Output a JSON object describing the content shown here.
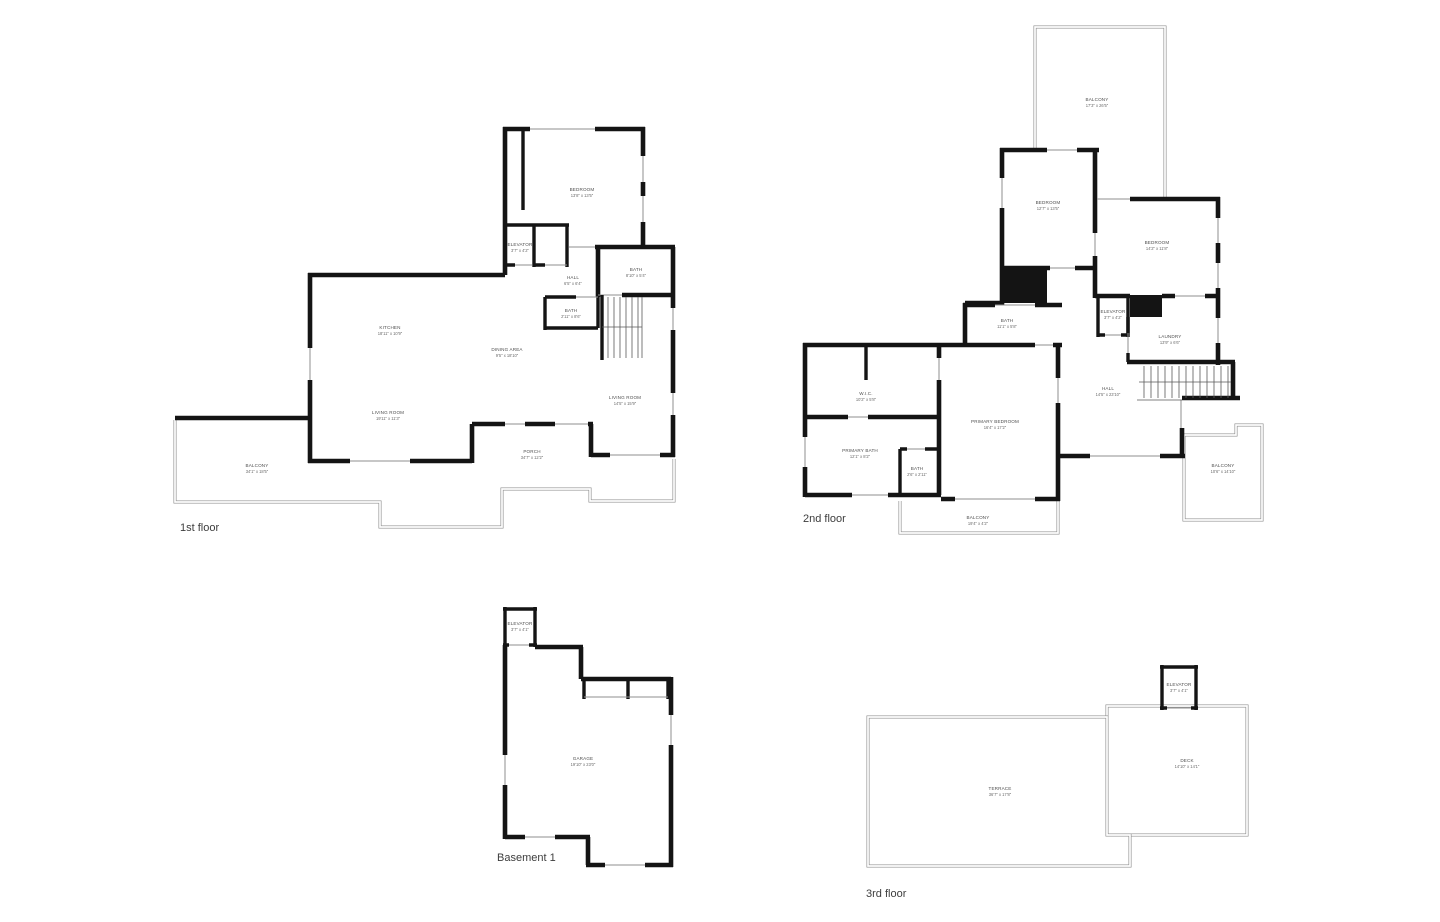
{
  "colors": {
    "wall": "#141414",
    "thin_outline": "#8f8f8f",
    "label_text": "#4f4f4f"
  },
  "floors": {
    "first": {
      "title": "1st floor",
      "rooms": {
        "bedroom": {
          "name": "BEDROOM",
          "dims": "13'8\" x 13'5\""
        },
        "elevator": {
          "name": "ELEVATOR",
          "dims": "3'7\" x 4'2\""
        },
        "hall": {
          "name": "HALL",
          "dims": "6'5\" x 6'4\""
        },
        "bath1": {
          "name": "BATH",
          "dims": "8'10\" x 5'4\""
        },
        "bath2": {
          "name": "BATH",
          "dims": "2'11\" x 8'6\""
        },
        "kitchen": {
          "name": "KITCHEN",
          "dims": "18'11\" x 10'9\""
        },
        "dining": {
          "name": "DINING AREA",
          "dims": "9'5\" x 18'10\""
        },
        "living1": {
          "name": "LIVING ROOM",
          "dims": "19'11\" x 11'3\""
        },
        "living2": {
          "name": "LIVING ROOM",
          "dims": "14'5\" x 15'9\""
        },
        "porch": {
          "name": "PORCH",
          "dims": "34'7\" x 12'2\""
        },
        "balcony": {
          "name": "BALCONY",
          "dims": "34'1\" x 18'5\""
        }
      }
    },
    "second": {
      "title": "2nd floor",
      "rooms": {
        "balcony_top": {
          "name": "BALCONY",
          "dims": "17'3\" x 26'5\""
        },
        "bedroom1": {
          "name": "BEDROOM",
          "dims": "12'7\" x 13'5\""
        },
        "bedroom2": {
          "name": "BEDROOM",
          "dims": "14'2\" x 11'8\""
        },
        "bath1": {
          "name": "BATH",
          "dims": "11'1\" x 5'8\""
        },
        "elevator": {
          "name": "ELEVATOR",
          "dims": "3'7\" x 4'2\""
        },
        "laundry": {
          "name": "LAUNDRY",
          "dims": "13'9\" x 6'6\""
        },
        "hall": {
          "name": "HALL",
          "dims": "14'5\" x 23'10\""
        },
        "wic": {
          "name": "W.I.C.",
          "dims": "10'2\" x 5'8\""
        },
        "primary_bath": {
          "name": "PRIMARY BATH",
          "dims": "12'1\" x 8'2\""
        },
        "bath2": {
          "name": "BATH",
          "dims": "2'6\" x 2'11\""
        },
        "primary_bedroom": {
          "name": "PRIMARY BEDROOM",
          "dims": "16'4\" x 17'2\""
        },
        "balcony_bottom": {
          "name": "BALCONY",
          "dims": "19'4\" x 4'2\""
        },
        "balcony_right": {
          "name": "BALCONY",
          "dims": "10'6\" x 14'10\""
        }
      }
    },
    "basement": {
      "title": "Basement 1",
      "rooms": {
        "elevator": {
          "name": "ELEVATOR",
          "dims": "3'7\" x 4'1\""
        },
        "garage": {
          "name": "GARAGE",
          "dims": "19'10\" x 23'0\""
        }
      }
    },
    "third": {
      "title": "3rd floor",
      "rooms": {
        "elevator": {
          "name": "ELEVATOR",
          "dims": "3'7\" x 4'1\""
        },
        "deck": {
          "name": "DECK",
          "dims": "14'10\" x 14'1\""
        },
        "terrace": {
          "name": "TERRACE",
          "dims": "36'7\" x 17'8\""
        }
      }
    }
  }
}
